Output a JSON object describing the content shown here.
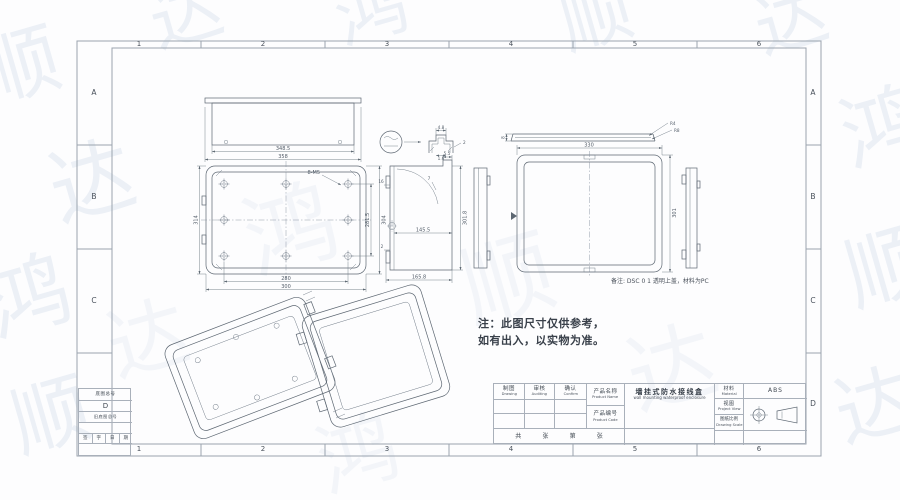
{
  "sheet": {
    "zone_columns": [
      "1",
      "2",
      "3",
      "4",
      "5",
      "6"
    ],
    "zone_rows": [
      "A",
      "B",
      "C",
      "D"
    ]
  },
  "watermark": {
    "color": "#7d9cc6",
    "items": [
      {
        "ch": "顺"
      },
      {
        "ch": "达"
      },
      {
        "ch": "鸿"
      },
      {
        "ch": "顺"
      },
      {
        "ch": "达"
      },
      {
        "ch": "鸿"
      },
      {
        "ch": "顺"
      },
      {
        "ch": "达"
      },
      {
        "ch": "鸿"
      },
      {
        "ch": "顺"
      },
      {
        "ch": "达"
      },
      {
        "ch": "鸿"
      },
      {
        "ch": "顺"
      },
      {
        "ch": "达"
      },
      {
        "ch": "鸿"
      },
      {
        "ch": "达"
      }
    ]
  },
  "note": {
    "line1": "注：此图尺寸仅供参考，",
    "line2": "如有出入，以实物为准。"
  },
  "remark": "备注: DSC 0 1 透明上盖，材料为PC",
  "corner_table": {
    "row1": "底图总号",
    "zone": "D",
    "row2": "旧底图总号",
    "sig_cells": [
      "签",
      "字",
      "日",
      "期"
    ]
  },
  "title_block": {
    "sig_cols": [
      {
        "cn": "制图",
        "en": "Drawing"
      },
      {
        "cn": "审核",
        "en": "Auditing"
      },
      {
        "cn": "确认",
        "en": "Confirm"
      }
    ],
    "product_name_label": {
      "cn": "产品名称",
      "en": "Product Name"
    },
    "product_code_label": {
      "cn": "产品编号",
      "en": "Product Code"
    },
    "product_name": {
      "cn": "墙挂式防水接线盒",
      "en": "wall mounting waterproof enclosure"
    },
    "material_label": {
      "cn": "材料",
      "en": "Material"
    },
    "material_value": "ABS",
    "view_label": {
      "cn": "视图",
      "en": "Project View"
    },
    "scale_label": {
      "cn": "图纸比例",
      "en": "Drawing Scale"
    },
    "sheet_row": [
      "共",
      "张",
      "第",
      "张"
    ]
  },
  "dims": {
    "width_a": "348.5",
    "width_b": "358",
    "front_left": "314",
    "front_right_inner": "281.5",
    "front_right_outer": "304",
    "front_bottom_inner": "280",
    "front_bottom_outer": "300",
    "front_holes": "8-M5",
    "detail_top": "4.8",
    "detail_right": "2",
    "detail_bottom": "1.6",
    "section_step": "5.5",
    "section_angle": "7",
    "section_left_a": "16",
    "section_left_b": "2",
    "section_mid": "145.5",
    "section_bottom": "165.8",
    "section_height": "301.8",
    "lid_thickness": "8",
    "lid_r1": "R4",
    "lid_r2": "R8",
    "lid_width": "330",
    "lid_height": "301"
  }
}
